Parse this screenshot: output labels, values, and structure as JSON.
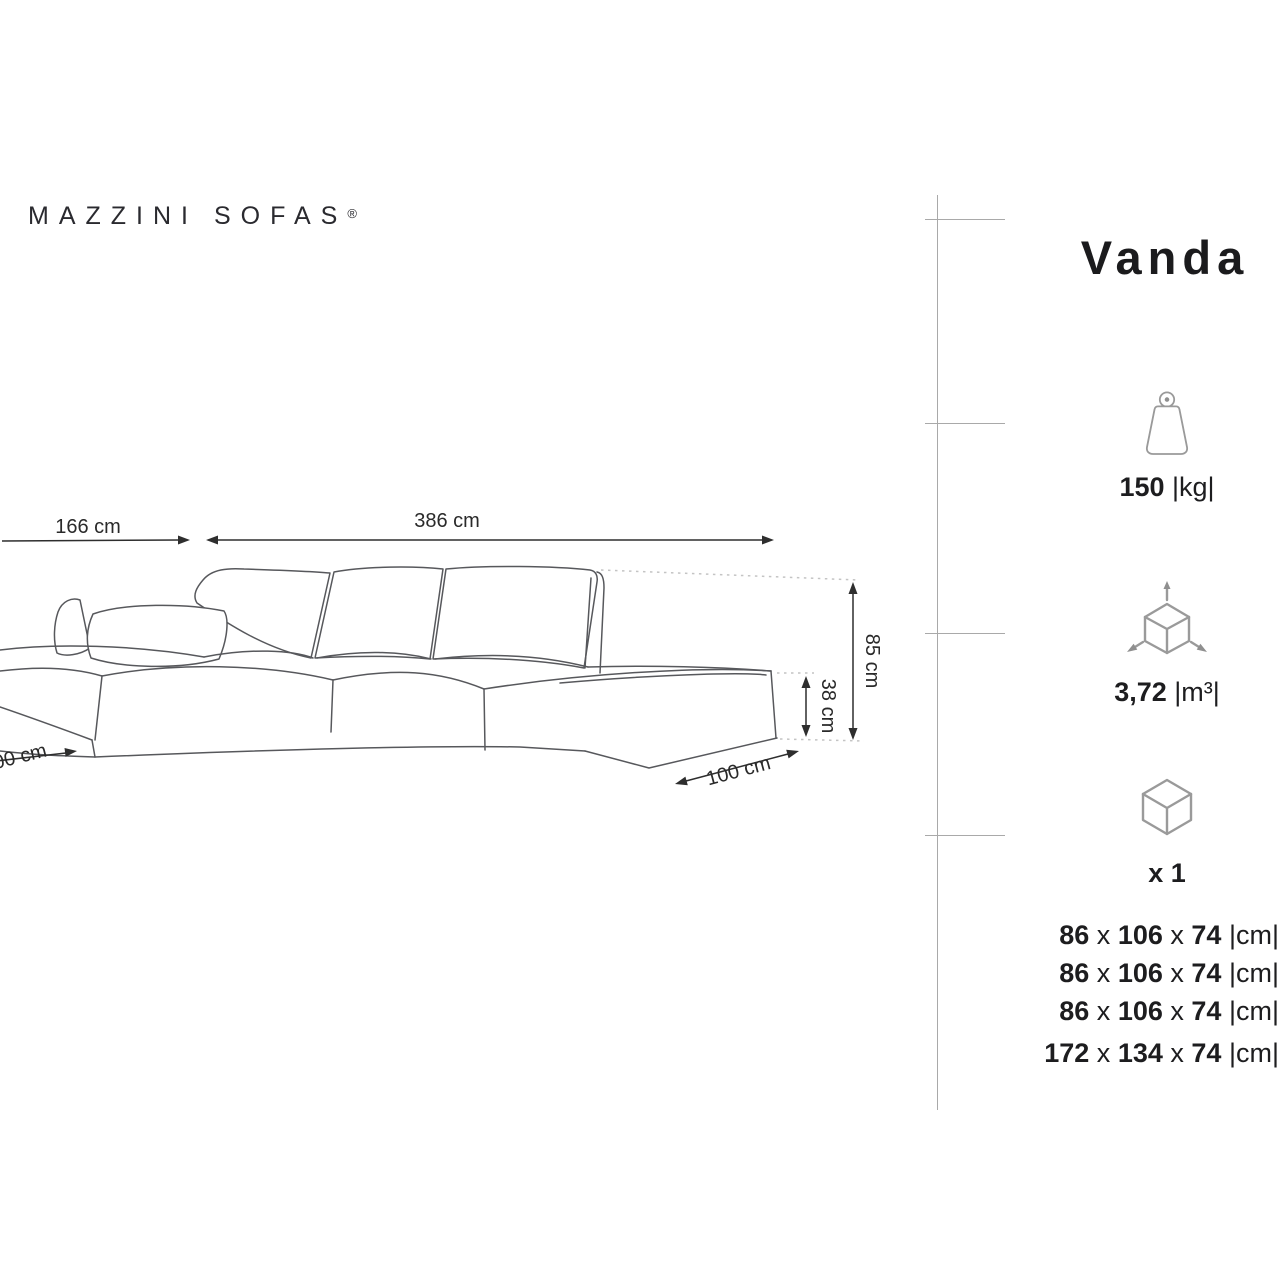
{
  "brand": {
    "word1": "MAZZINI",
    "word2": "SOFAS",
    "registered": "®"
  },
  "product": {
    "title": "Vanda"
  },
  "diagram": {
    "width_left": "166 cm",
    "width_total": "386 cm",
    "height": "85 cm",
    "seat_height": "38 cm",
    "depth_right": "100 cm",
    "depth_left": "100 cm"
  },
  "specs": {
    "weight_value": "150",
    "weight_unit": "|kg|",
    "weight_icon": "weight-icon",
    "volume_value": "3,72",
    "volume_unit": "|m³|",
    "volume_icon": "volume-cube-icon",
    "quantity": "x 1",
    "package_icon": "package-box-icon",
    "separator": "x",
    "unit_cm": "|cm|",
    "modules": [
      {
        "w": "86",
        "d": "106",
        "h": "74"
      },
      {
        "w": "86",
        "d": "106",
        "h": "74"
      },
      {
        "w": "86",
        "d": "106",
        "h": "74"
      },
      {
        "w": "172",
        "d": "134",
        "h": "74"
      }
    ]
  },
  "colors": {
    "text": "#1d1d1f",
    "sketch_line": "#57585c",
    "dash_line": "#c4c4c4",
    "icon_line": "#9a9a9a",
    "divider": "#a9a9a9"
  }
}
